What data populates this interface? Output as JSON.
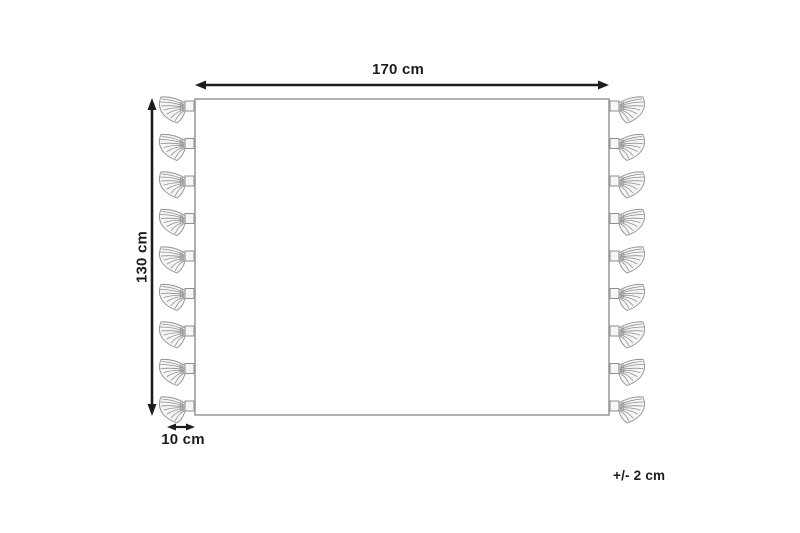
{
  "diagram": {
    "labels": {
      "width": "170 cm",
      "height": "130 cm",
      "fringe": "10 cm",
      "tolerance": "+/- 2 cm"
    },
    "tassels_per_side": 9,
    "colors": {
      "background": "#ffffff",
      "dimension": "#1d1d1b",
      "outline": "#9d9d9c",
      "tassel_stroke": "#8f8f8f",
      "tassel_fill": "#f6f6f6"
    }
  }
}
